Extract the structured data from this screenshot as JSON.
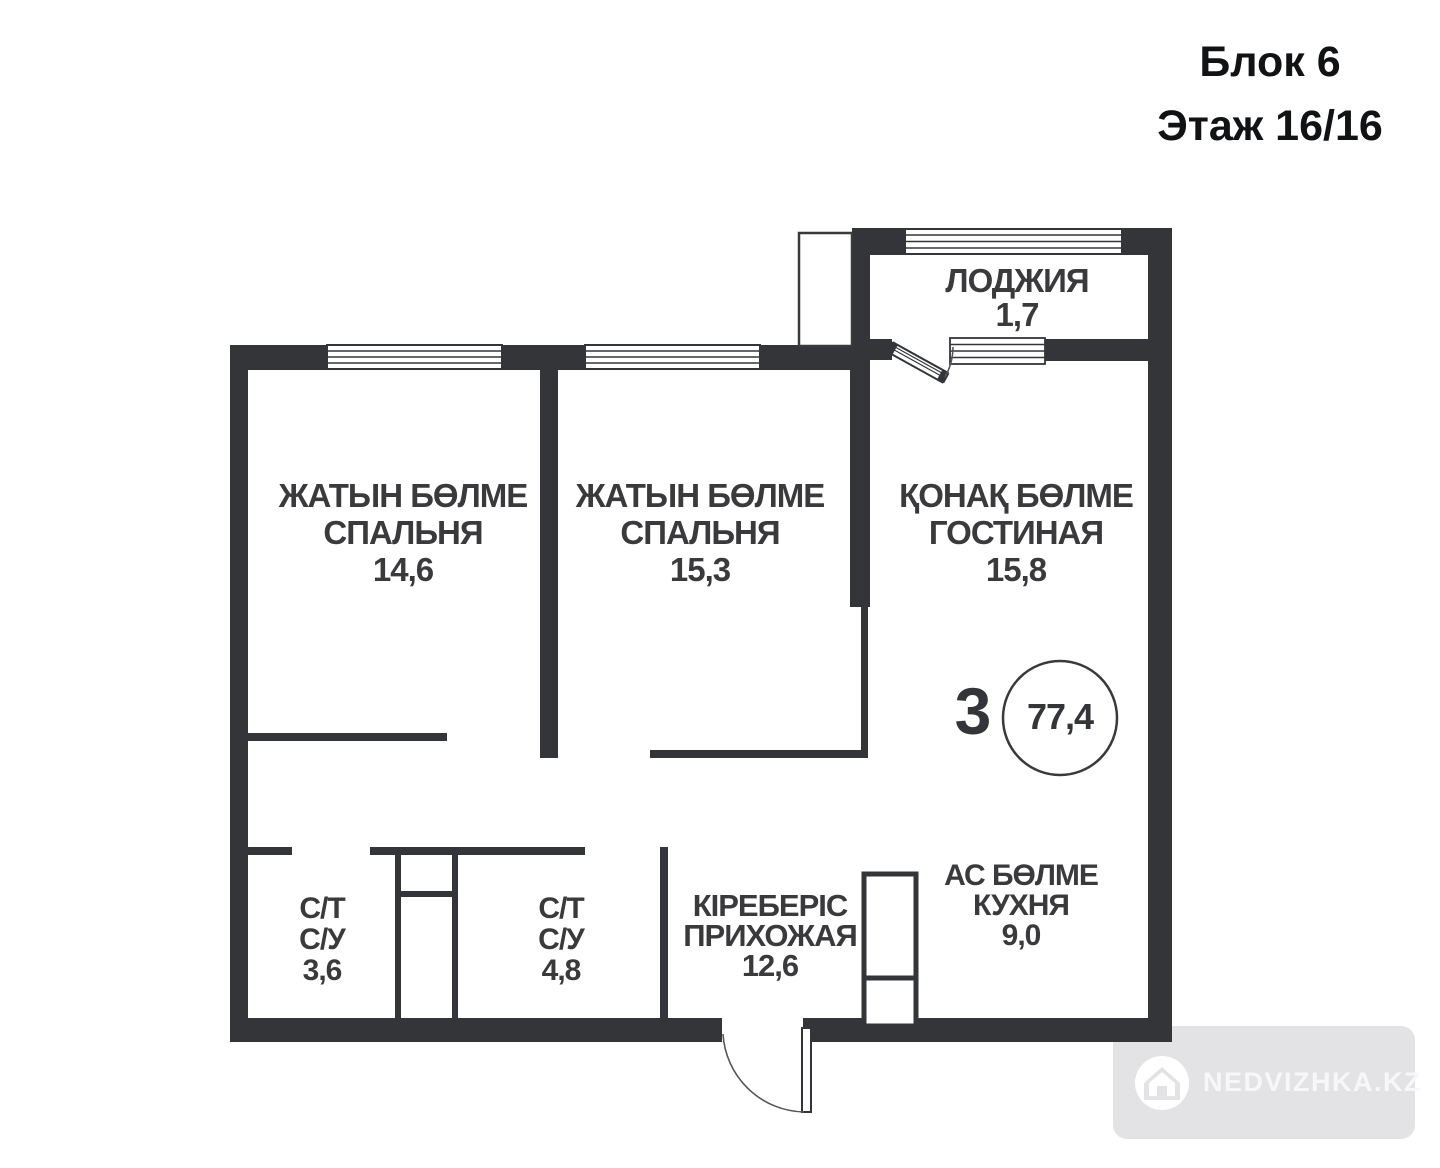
{
  "header": {
    "block": "Блок 6",
    "floor": "Этаж 16/16"
  },
  "plan": {
    "rooms": [
      {
        "id": "bedroom-1",
        "name_kk": "ЖАТЫН БӨЛМЕ",
        "name_ru": "СПАЛЬНЯ",
        "area": "14,6"
      },
      {
        "id": "bedroom-2",
        "name_kk": "ЖАТЫН БӨЛМЕ",
        "name_ru": "СПАЛЬНЯ",
        "area": "15,3"
      },
      {
        "id": "living",
        "name_kk": "ҚОНАҚ БӨЛМЕ",
        "name_ru": "ГОСТИНАЯ",
        "area": "15,8"
      },
      {
        "id": "loggia",
        "name_kk": "ЛОДЖИЯ",
        "name_ru": "",
        "area": "1,7"
      },
      {
        "id": "bath-1",
        "name_kk": "С/Т",
        "name_ru": "С/У",
        "area": "3,6"
      },
      {
        "id": "bath-2",
        "name_kk": "С/Т",
        "name_ru": "С/У",
        "area": "4,8"
      },
      {
        "id": "hallway",
        "name_kk": "КІРЕБЕРІС",
        "name_ru": "ПРИХОЖАЯ",
        "area": "12,6"
      },
      {
        "id": "kitchen",
        "name_kk": "АС БӨЛМЕ",
        "name_ru": "КУХНЯ",
        "area": "9,0"
      }
    ],
    "apartment": {
      "rooms_count": "3",
      "total_area": "77,4"
    },
    "colors": {
      "wall": "#333538",
      "label_text": "#3a3a3c",
      "header_text": "#111214",
      "watermark_bg": "#e3e3e5",
      "watermark_text": "#f7f7f9"
    }
  },
  "watermark": {
    "text": "NEDVIZHKA.KZ"
  }
}
